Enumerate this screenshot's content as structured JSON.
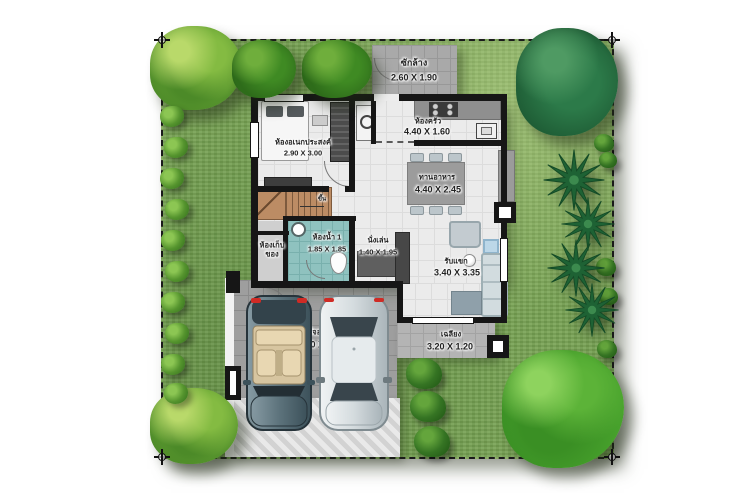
{
  "plan": {
    "rooms": [
      {
        "id": "laundry",
        "name": "ซักล้าง",
        "dim": "2.60 X 1.90"
      },
      {
        "id": "multipurpose",
        "name": "ห้องอเนกประสงค์",
        "dim": "2.90 X 3.00"
      },
      {
        "id": "kitchen",
        "name": "ห้องครัว",
        "dim": "4.40 X 1.60"
      },
      {
        "id": "dining",
        "name": "ทานอาหาร",
        "dim": "4.40 X 2.45"
      },
      {
        "id": "bathroom",
        "name": "ห้องน้ำ 1",
        "dim": "1.85 X 1.85"
      },
      {
        "id": "storage",
        "name": "ห้องเก็บของ",
        "dim": ""
      },
      {
        "id": "sitting",
        "name": "นั่งเล่น",
        "dim": "1.40 X 1.95"
      },
      {
        "id": "living",
        "name": "รับแขก",
        "dim": "3.40 X 3.35"
      },
      {
        "id": "porch",
        "name": "เฉลียง",
        "dim": "3.20 X 1.20"
      },
      {
        "id": "parking",
        "name": "ที่จอดรถ",
        "dim": "5.10 X 4.40"
      }
    ],
    "annotations": {
      "stairs_up": "ขึ้น",
      "counter_dim": "1.50X0.5"
    },
    "colors": {
      "lawn": "#78a254",
      "house_floor": "#ebebeb",
      "garage_floor": "#9e9e9e",
      "bathroom_floor": "#8fc2bf",
      "stairs_wood": "#bc8c64",
      "wall": "#161616",
      "car_convertible": "#5d737c",
      "car_sedan": "#dfe5e7",
      "boundary_dash": "#1b1b1b"
    }
  }
}
